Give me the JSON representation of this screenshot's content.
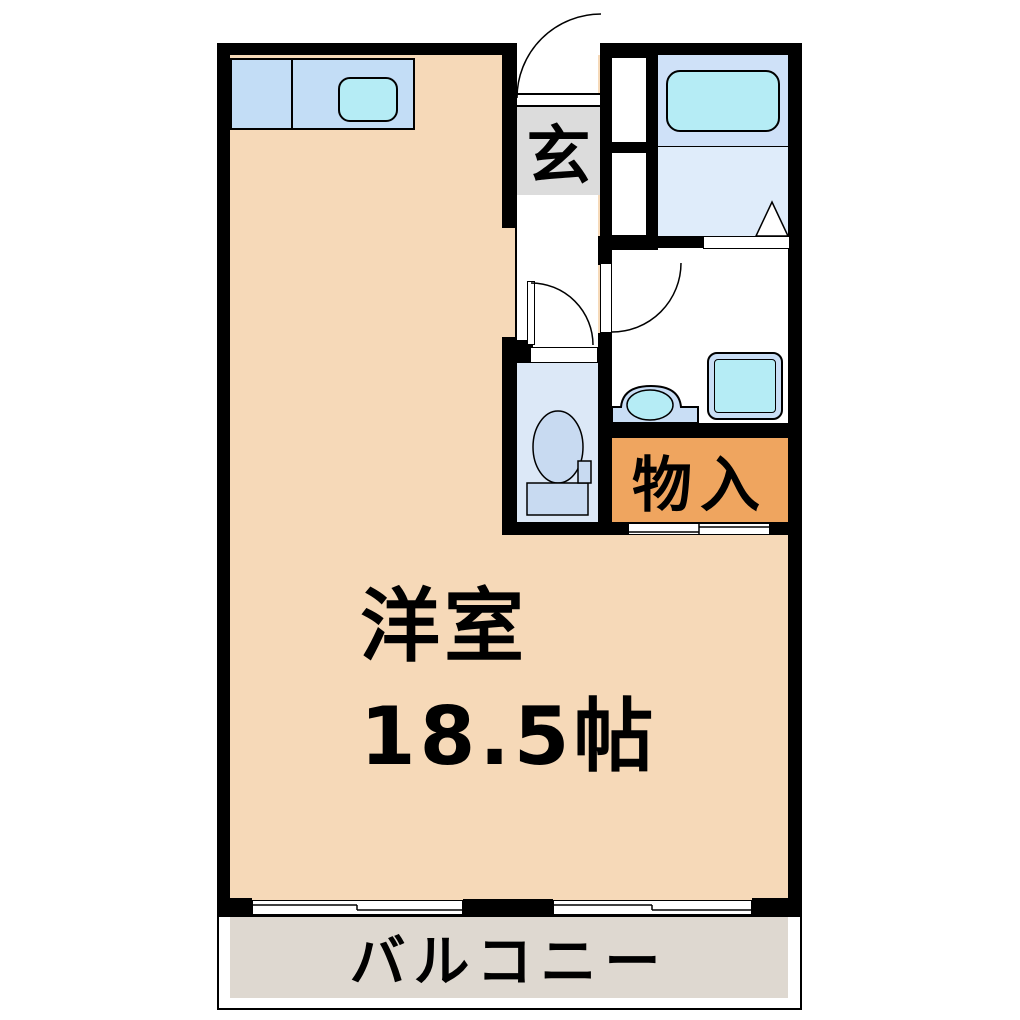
{
  "floor_plan": {
    "type": "japanese-apartment-floor-plan",
    "rooms": {
      "main_room": {
        "name": "洋室",
        "size": "18.5帖"
      },
      "entrance": {
        "label": "玄"
      },
      "storage": {
        "label": "物入"
      },
      "balcony": {
        "label": "バルコニー"
      }
    },
    "fixtures": [
      "kitchen-counter-with-sink",
      "bathtub",
      "washbasin",
      "washing-machine-pan",
      "toilet",
      "sliding-windows",
      "sliding-closet-door"
    ],
    "colors": {
      "wall": "#000000",
      "main_room_floor": "#f6d9b8",
      "kitchen_counter": "#c3ddf6",
      "fixture_cyan": "#b5ecf5",
      "fixture_blue": "#c9def5",
      "bath_upper": "#cfe1f8",
      "bath_lower": "#dfecfa",
      "toilet_floor": "#dce8f7",
      "toilet_fixture": "#c8daf1",
      "entrance_floor": "#dcdcdc",
      "storage_fill": "#efa55f",
      "balcony_floor": "#ded8d0"
    }
  }
}
